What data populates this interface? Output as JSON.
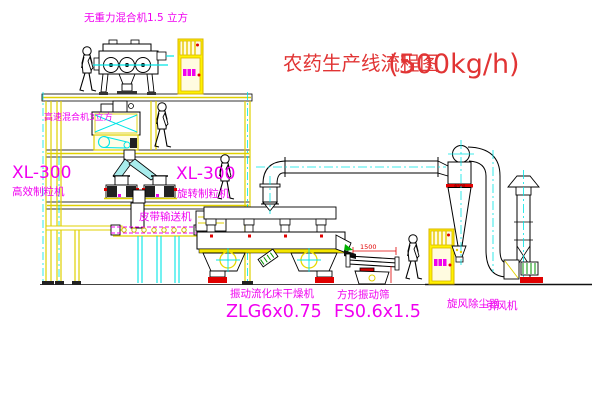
{
  "title": {
    "name": "农药生产线流程图",
    "capacity": "(500kg/h)"
  },
  "labels": {
    "gravity_mixer": "无重力混合机1.5 立方",
    "high_speed_mixer": "高速混合机3立方",
    "granulator_left_model": "XL-300",
    "granulator_left_name": "高效制粒机",
    "granulator_right_model": "XL-300",
    "granulator_right_name": "旋转制粒机",
    "belt_conveyor": "皮带输送机",
    "dryer_name": "振动流化床干燥机",
    "dryer_model": "ZLG6x0.75",
    "screen_name": "方形振动筛",
    "screen_model": "FS0.6x1.5",
    "cyclone": "旋风除尘器",
    "fan": "引风机"
  },
  "dimensions": {
    "screen_length": "1500",
    "cyclone_diameter": "Φ500"
  },
  "colors": {
    "line_yellow": "#e0d000",
    "centerline_cyan": "#00e5e5",
    "label_magenta": "#f000f0",
    "title_red": "#e13434",
    "accent_red": "#e00000",
    "motor_green": "#009000",
    "outline_black": "#000000"
  }
}
